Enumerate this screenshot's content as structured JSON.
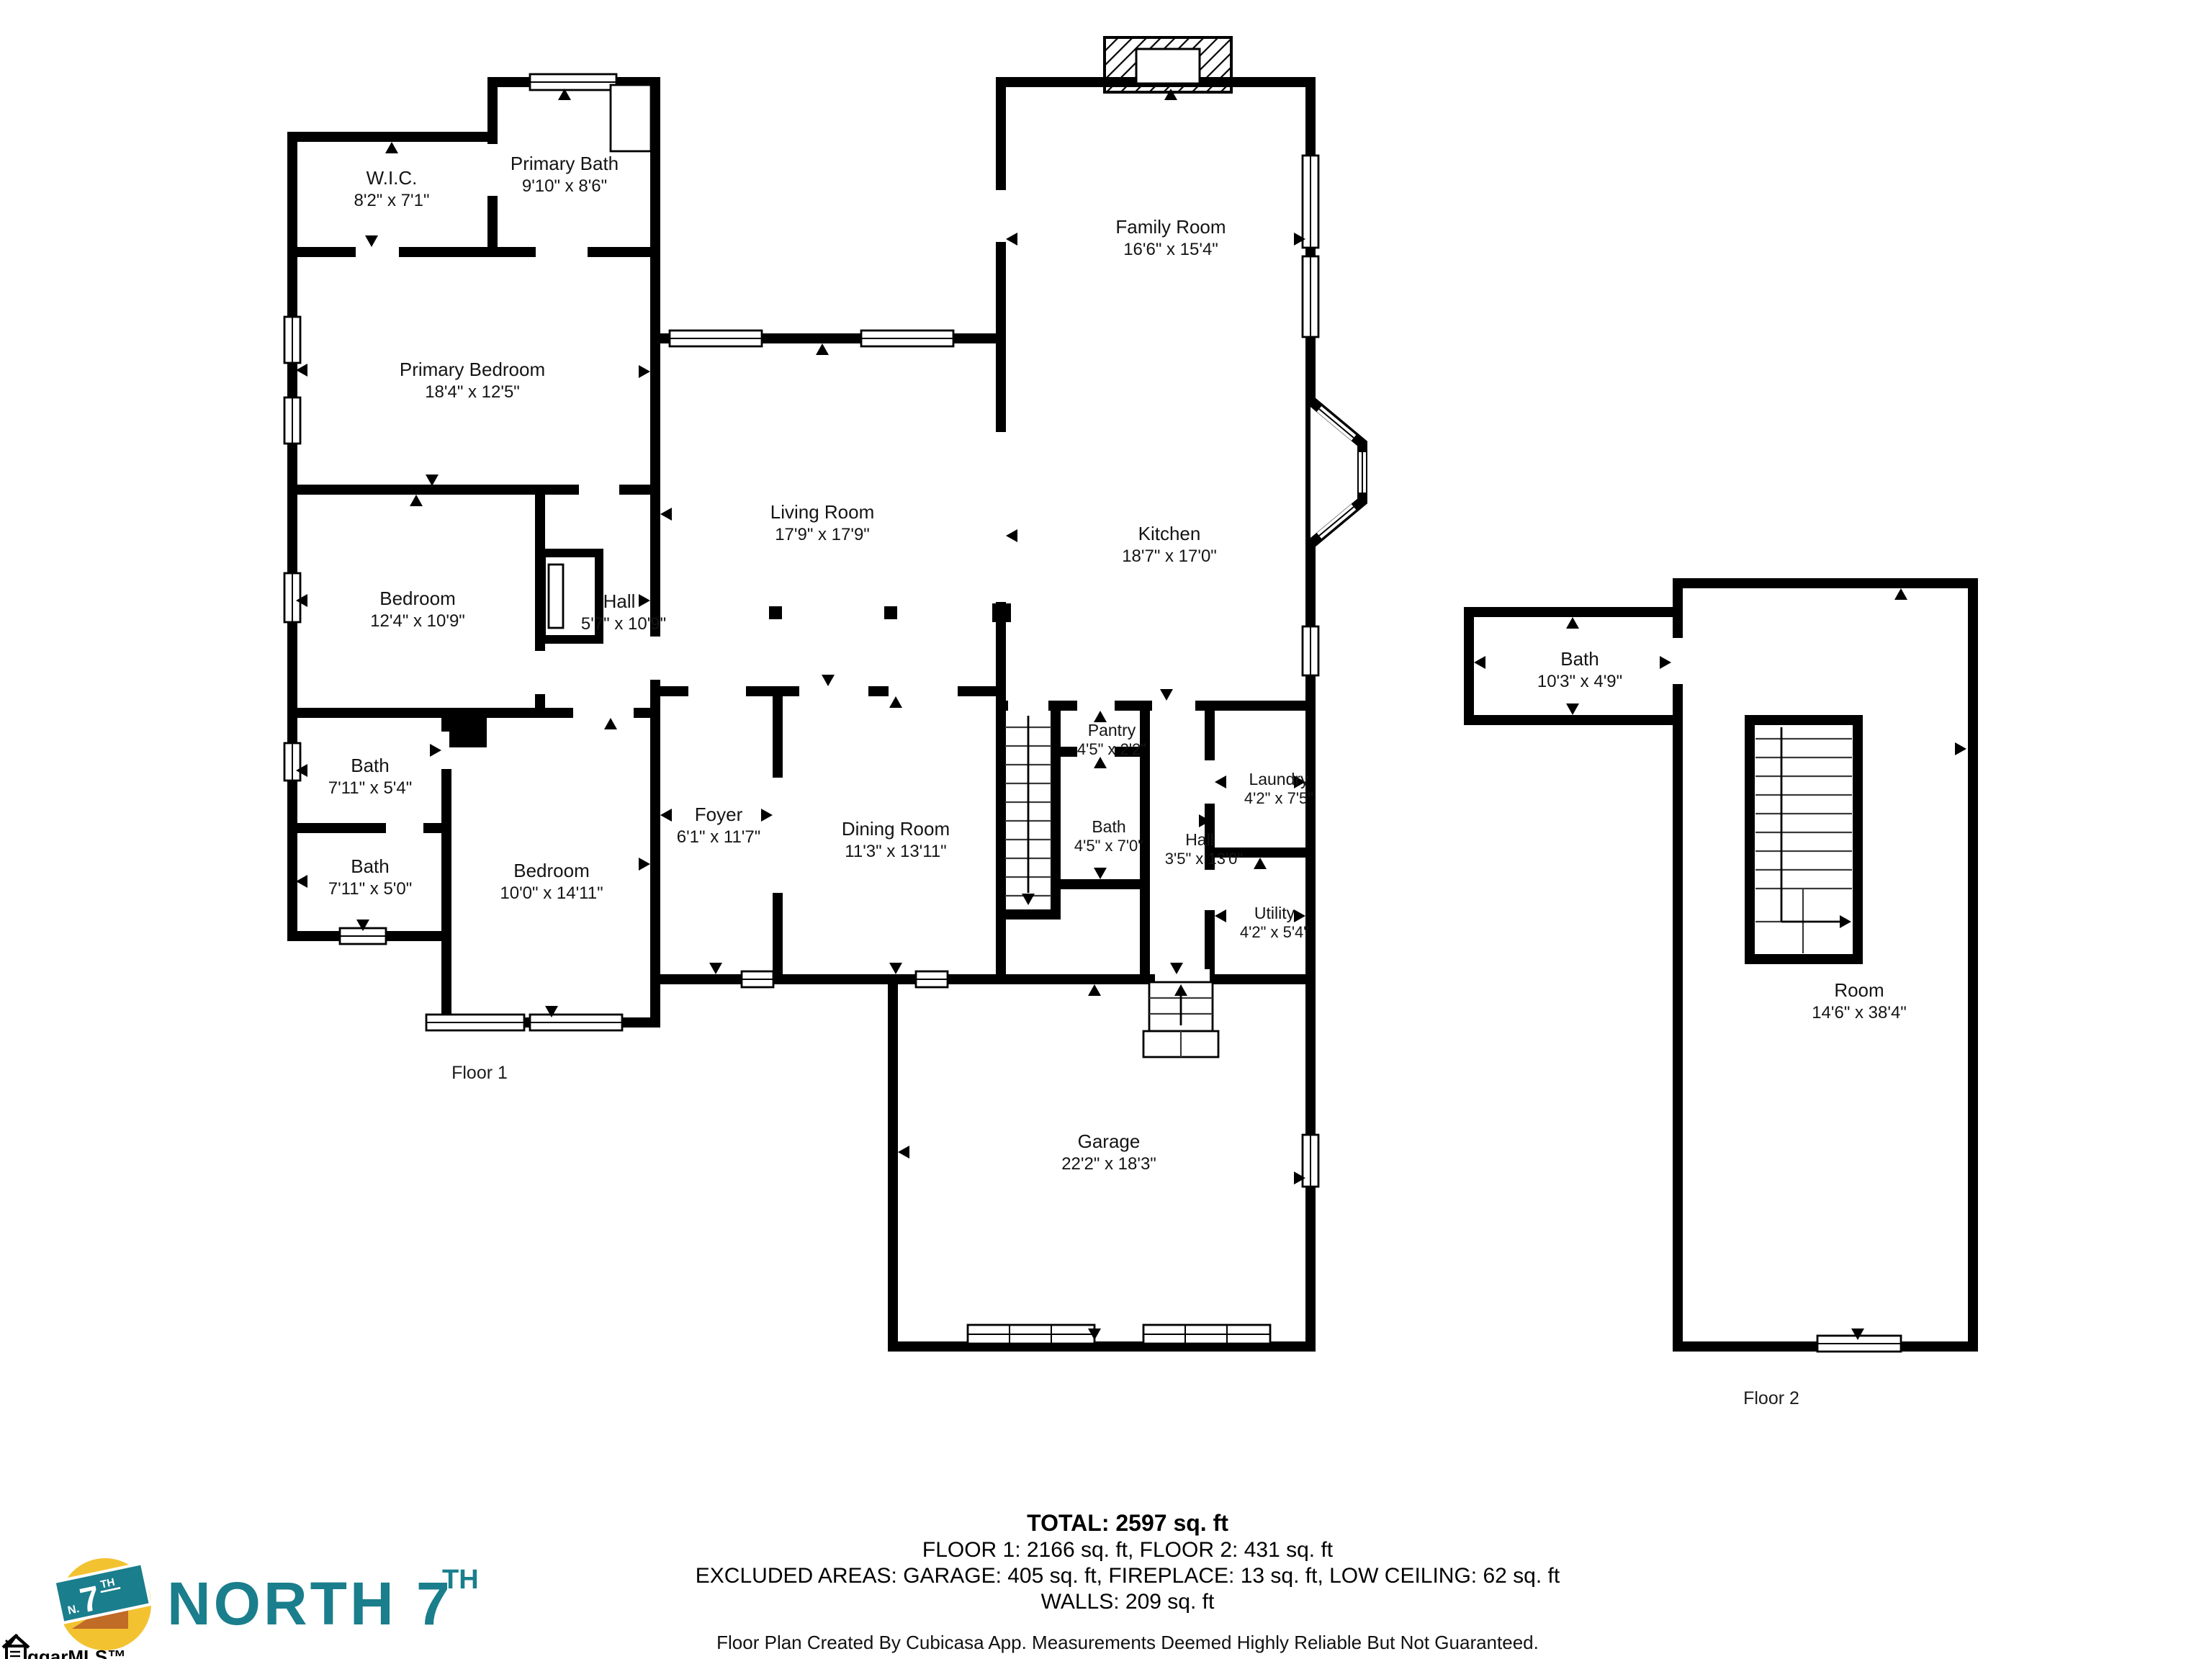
{
  "floors": {
    "floor1": {
      "label": "Floor 1",
      "rooms": {
        "wic": {
          "name": "W.I.C.",
          "dims": "8'2\" x 7'1\""
        },
        "primary_bath": {
          "name": "Primary Bath",
          "dims": "9'10\" x 8'6\""
        },
        "primary_bedroom": {
          "name": "Primary Bedroom",
          "dims": "18'4\" x 12'5\""
        },
        "bedroom_12": {
          "name": "Bedroom",
          "dims": "12'4\" x 10'9\""
        },
        "hall_upper": {
          "name": "Hall",
          "dims": "5'7\" x 10'9\""
        },
        "bath_54": {
          "name": "Bath",
          "dims": "7'11\" x 5'4\""
        },
        "bath_50": {
          "name": "Bath",
          "dims": "7'11\" x 5'0\""
        },
        "bedroom_10": {
          "name": "Bedroom",
          "dims": "10'0\" x 14'11\""
        },
        "foyer": {
          "name": "Foyer",
          "dims": "6'1\" x 11'7\""
        },
        "dining_room": {
          "name": "Dining Room",
          "dims": "11'3\" x 13'11\""
        },
        "living_room": {
          "name": "Living Room",
          "dims": "17'9\" x 17'9\""
        },
        "family_room": {
          "name": "Family Room",
          "dims": "16'6\" x 15'4\""
        },
        "kitchen": {
          "name": "Kitchen",
          "dims": "18'7\" x 17'0\""
        },
        "pantry": {
          "name": "Pantry",
          "dims": "4'5\" x 2'2\""
        },
        "bath_small": {
          "name": "Bath",
          "dims": "4'5\" x 7'0\""
        },
        "hall_lower": {
          "name": "Hall",
          "dims": "3'5\" x 13'0\""
        },
        "laundry": {
          "name": "Laundry",
          "dims": "4'2\" x 7'5\""
        },
        "utility": {
          "name": "Utility",
          "dims": "4'2\" x 5'4\""
        },
        "garage": {
          "name": "Garage",
          "dims": "22'2\" x 18'3\""
        }
      }
    },
    "floor2": {
      "label": "Floor 2",
      "rooms": {
        "bath": {
          "name": "Bath",
          "dims": "10'3\" x 4'9\""
        },
        "room": {
          "name": "Room",
          "dims": "14'6\" x 38'4\""
        }
      }
    }
  },
  "summary": {
    "total": "TOTAL: 2597 sq. ft",
    "floors_line": "FLOOR 1: 2166 sq. ft, FLOOR 2: 431 sq. ft",
    "excluded_line": "EXCLUDED AREAS: GARAGE: 405 sq. ft, FIREPLACE: 13 sq. ft, LOW CEILING: 62 sq. ft",
    "walls_line": "WALLS: 209 sq. ft",
    "disclaimer": "Floor Plan Created By Cubicasa App. Measurements Deemed Highly Reliable But Not Guaranteed."
  },
  "branding": {
    "wordmark": "NORTH 7",
    "wordmark_suffix": "TH",
    "badge_prefix": "N.",
    "badge_number": "7",
    "badge_suffix": "TH",
    "colors": {
      "teal": "#1A7E8C",
      "yellow": "#F3C230",
      "orange": "#C06B26"
    }
  },
  "watermark": {
    "text": "ggarMLS™"
  }
}
